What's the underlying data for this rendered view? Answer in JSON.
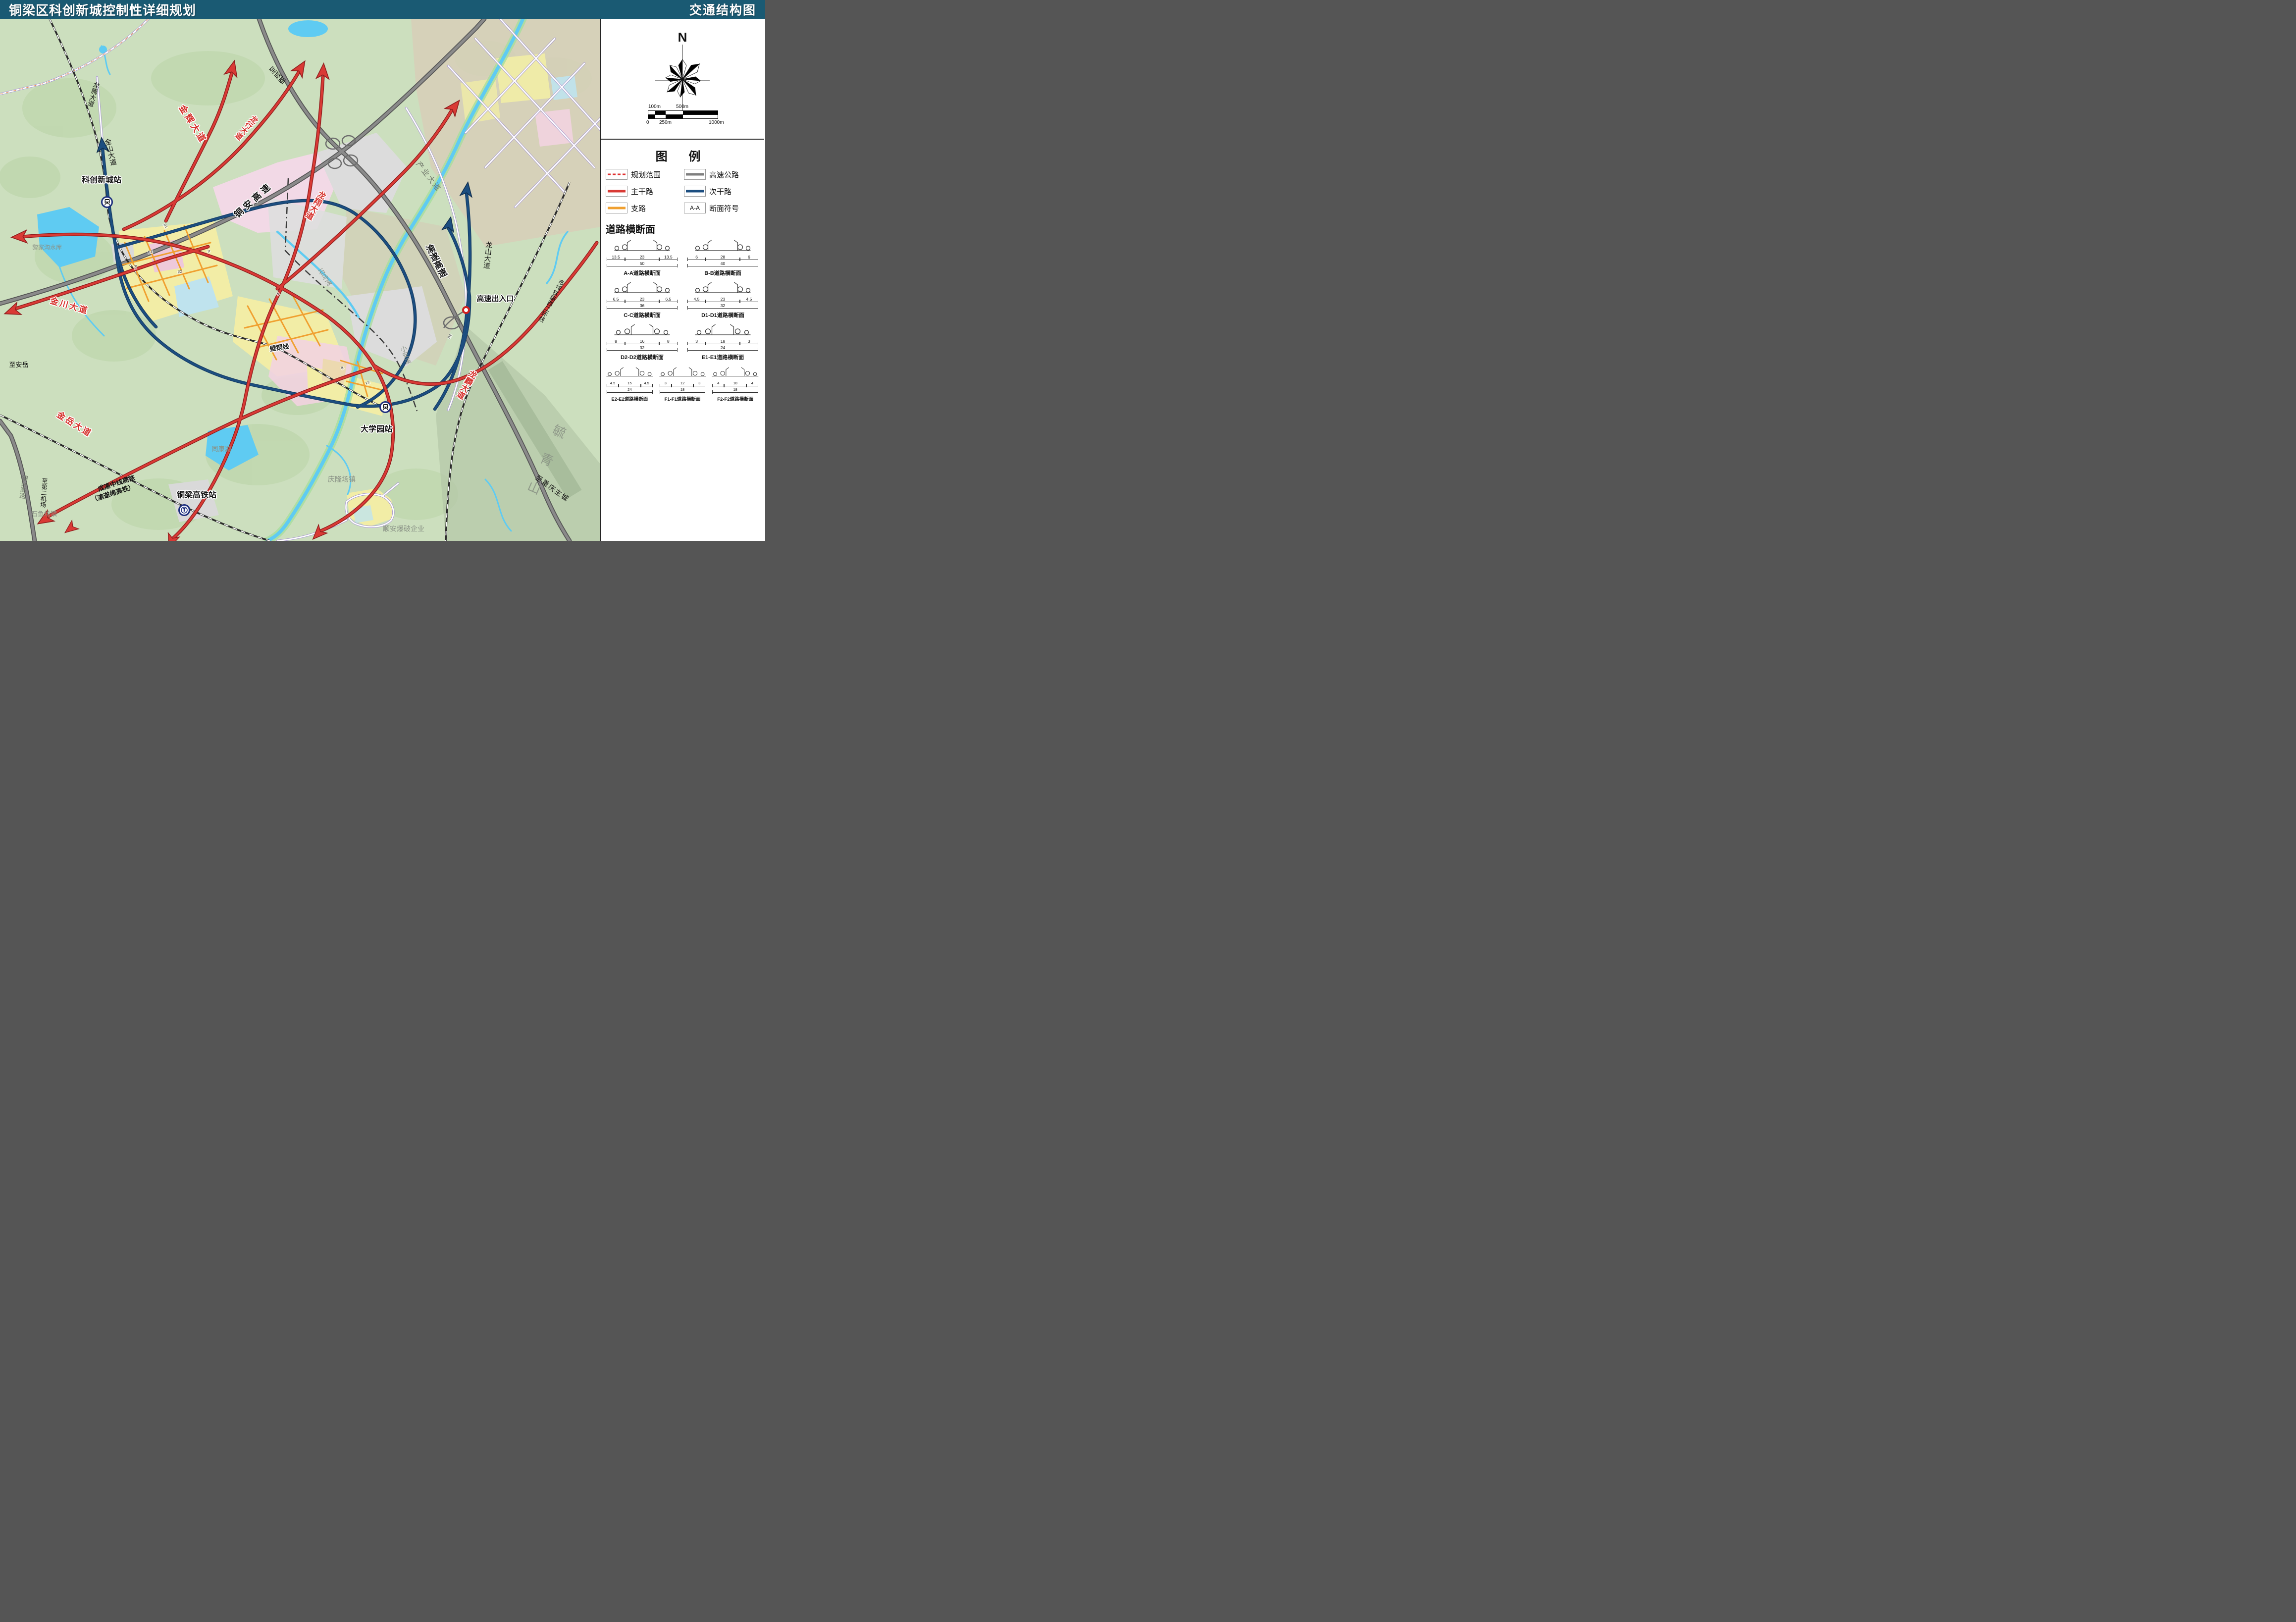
{
  "header": {
    "title": "铜梁区科创新城控制性详细规划",
    "doc_title": "交通结构图"
  },
  "panel": {
    "compass_label": "N",
    "scalebar": {
      "l100": "100m",
      "l500": "500m",
      "l0": "0",
      "l250": "250m",
      "l1000": "1000m"
    },
    "legend": {
      "title": "图  例",
      "items": [
        {
          "label": "规划范围"
        },
        {
          "label": "主干路"
        },
        {
          "label": "支路"
        },
        {
          "label": "高速公路"
        },
        {
          "label": "次干路"
        },
        {
          "label": "断面符号",
          "symbol": "A-A"
        }
      ]
    },
    "sections": {
      "title": "道路横断面",
      "items": [
        {
          "name": "A-A道路横断面",
          "dims": [
            "13.5",
            "23",
            "13.5"
          ],
          "total": "50"
        },
        {
          "name": "B-B道路横断面",
          "dims": [
            "6",
            "28",
            "6"
          ],
          "total": "40"
        },
        {
          "name": "C-C道路横断面",
          "dims": [
            "6.5",
            "23",
            "6.5"
          ],
          "total": "36"
        },
        {
          "name": "D1-D1道路横断面",
          "dims": [
            "4.5",
            "23",
            "4.5"
          ],
          "total": "32"
        },
        {
          "name": "D2-D2道路横断面",
          "dims": [
            "8",
            "16",
            "8"
          ],
          "total": "32"
        },
        {
          "name": "E1-E1道路横断面",
          "dims": [
            "3",
            "18",
            "3"
          ],
          "total": "24"
        },
        {
          "name": "E2-E2道路横断面",
          "dims": [
            "4.5",
            "15",
            "4.5"
          ],
          "total": "24"
        },
        {
          "name": "F1-F1道路横断面",
          "dims": [
            "3",
            "12",
            "3"
          ],
          "total": "18"
        },
        {
          "name": "F2-F2道路横断面",
          "dims": [
            "4",
            "10",
            "4"
          ],
          "total": "18"
        }
      ]
    }
  },
  "map": {
    "labels": [
      {
        "text": "龙腾大道"
      },
      {
        "text": "金山大道"
      },
      {
        "text": "科创新城站"
      },
      {
        "text": "金辉大道"
      },
      {
        "text": "龙行大道"
      },
      {
        "text": "至成都"
      },
      {
        "text": "铜安高速"
      },
      {
        "text": "龙翔大道"
      },
      {
        "text": "产业大道"
      },
      {
        "text": "渝遂高速"
      },
      {
        "text": "龙山大道"
      },
      {
        "text": "高速出入口"
      },
      {
        "text": "石马溪"
      },
      {
        "text": "小安溪"
      },
      {
        "text": "璧铜线"
      },
      {
        "text": "黎家沟水库"
      },
      {
        "text": "金川大道"
      },
      {
        "text": "至安岳"
      },
      {
        "text": "金岳大道"
      },
      {
        "text": "铜兴高速"
      },
      {
        "text": "至第二机场"
      },
      {
        "text": "成渝中线高铁"
      },
      {
        "text": "（渝遂绵高铁）"
      },
      {
        "text": "石鱼场镇"
      },
      {
        "text": "铜梁高铁站"
      },
      {
        "text": "同康湖"
      },
      {
        "text": "庆隆场镇"
      },
      {
        "text": "顺安爆破企业"
      },
      {
        "text": "大学园站"
      },
      {
        "text": "龙麟大道"
      },
      {
        "text": "市域铁路西二环线"
      },
      {
        "text": "毓青山"
      },
      {
        "text": "至重庆主城"
      }
    ],
    "section_markers": [
      {
        "t": "A"
      },
      {
        "t": "A"
      },
      {
        "t": "B"
      },
      {
        "t": "D1"
      },
      {
        "t": "D2"
      },
      {
        "t": "E1"
      },
      {
        "t": "E2"
      },
      {
        "t": "F1"
      },
      {
        "t": "F2"
      }
    ],
    "colors": {
      "arterial": "#d93a35",
      "secondary": "#1c4e80",
      "branch": "#f0a030",
      "expressway": "#7f7f7f",
      "header_bg": "#1a5a73",
      "water": "#5fcbf2"
    }
  }
}
